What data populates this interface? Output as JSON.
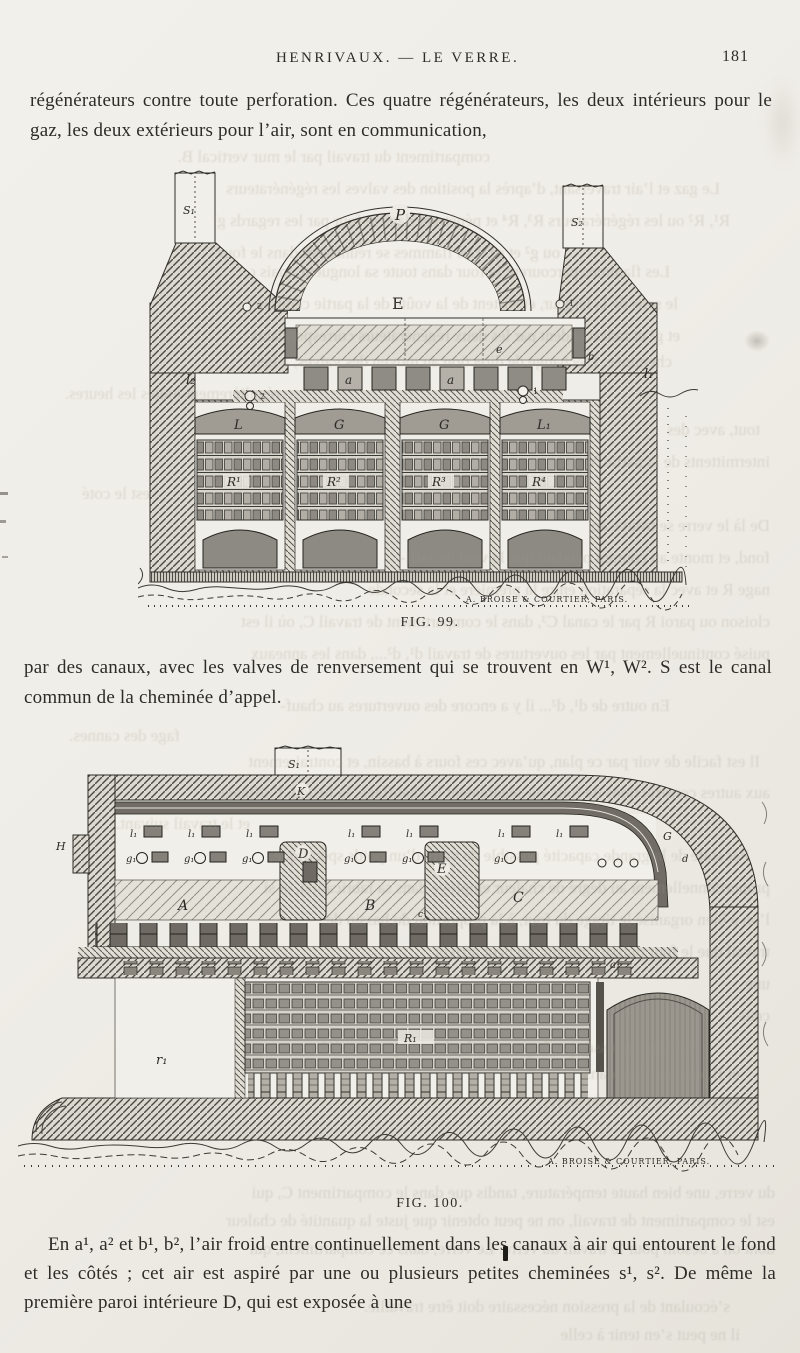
{
  "header": {
    "title": "HENRIVAUX. — LE VERRE.",
    "page_number": "181"
  },
  "paragraphs": {
    "p1": "régénérateurs contre toute perforation. Ces quatre régénérateurs, les deux intérieurs pour le gaz, les deux extérieurs pour l’air, sont en communication,",
    "p2": "par des canaux, avec les valves de renversement qui se trouvent en W¹, W². S est le canal commun de la cheminée d’appel.",
    "p3": "En a¹, a² et b¹, b², l’air froid entre continuellement dans les canaux à air qui entourent le fond et les côtés ; cet air est aspiré par une ou plusieurs petites cheminées s¹, s². De même la première paroi intérieure D, qui est exposée à une"
  },
  "fig99": {
    "caption": "FIG. 99.",
    "signature": "A. BROISE & COURTIER, PARIS.",
    "labels": {
      "s1": "S₁",
      "s2": "S₂",
      "p": "P",
      "e_big": "E",
      "e_small": "e",
      "b": "b",
      "a_left": "a",
      "a_right": "a",
      "l2": "l₂",
      "l1": "l₁",
      "v_left": "2",
      "v_right": "1"
    },
    "chambers": [
      {
        "arch": "L",
        "r": "R¹"
      },
      {
        "arch": "G",
        "r": "R²"
      },
      {
        "arch": "G",
        "r": "R³"
      },
      {
        "arch": "L₁",
        "r": "R⁴"
      }
    ]
  },
  "fig100": {
    "caption": "FIG. 100.",
    "signature": "A. BROISE & COURTIER, PARIS.",
    "labels": {
      "s1": "S₁",
      "k": "K",
      "h": "H",
      "d_pillar": "D",
      "e_pillar": "E",
      "a": "A",
      "b": "B",
      "c": "C",
      "g": "G",
      "d_small": "d",
      "c1": "c¹",
      "a1": "a₁",
      "r1": "r₁",
      "R1": "R₁",
      "l1": "l₁",
      "g1": "g₁"
    }
  },
  "bleedthrough": {
    "lines": [
      "compartiment du travail par le mur vertical B.",
      "Le gaz et l’air traversant, d’après la position des valves les régénérateurs",
      "R¹, R² ou les régénérateurs R³, R⁴ et pénètrent dans le four par les regards g¹",
      "ou g² et g⁴. Les flammes se réunissent dans le four",
      "Les flammes parcourent le four dans toute sa longueur, mais dans",
      "le sens de la largeur, et sortent de la voûte de la partie centrale par g²",
      "et g¹ et redescendent par les deux régénérateurs correspondants, à la",
      "cheminée. L’échange de direction au moyen des valves, a lieu",
      "régulièrement toutes les heures.",
      "tout, avec des",
      "intermittents de la partie X, qui",
      "est le coté",
      "De là le verre se trouve au",
      "fond, et monte au courant pendant que le vent de raffi-",
      "nage R et avec la séparation entre la première et la seconde",
      "cloison ou paroi R par le canal C³, dans le compartiment de travail C, où il est",
      "puisé continuellement par les ouvertures de travail d¹, d²..., dans les anneaux",
      "En outre de d¹, d²... il y a encore des ouvertures au chauf-",
      "fage des cannes.",
      "Il est facile de voir par ce plan, qu’avec ces fours à bassin, et contrairement",
      "aux autres constructions de four, où séparément le chauffage, la fusion, l’affinage",
      "et le travail suivant.",
      "Par suite de la grande capacité possible de verre d’un poids spécifique,",
      "proportionnellement au degré de chaleur employé dans sa fabrication, et si",
      "l’on a bien organisé le tirage du four, à la proportion du bassin de",
      "travail que le four puisse contenir, on peut arriver",
      "une",
      "cette",
      "chimique poussée par la pression hydrostatique dans l’écre-",
      "et B, encore mou, dans",
      "les parois ou parois du verre;",
      "du verre, une bien haute température, tandis que dans le compartiment C, qui",
      "est le compartiment de travail, on ne peut obtenir que juste la quantité de chaleur",
      "dont on a besoin pour le travail du verre. Le verre, dans ce compartiment, qui",
      "s’écoulant de la pression nécessaire doit être travaillé.",
      "il ne peut s’en tenir à celle"
    ]
  }
}
